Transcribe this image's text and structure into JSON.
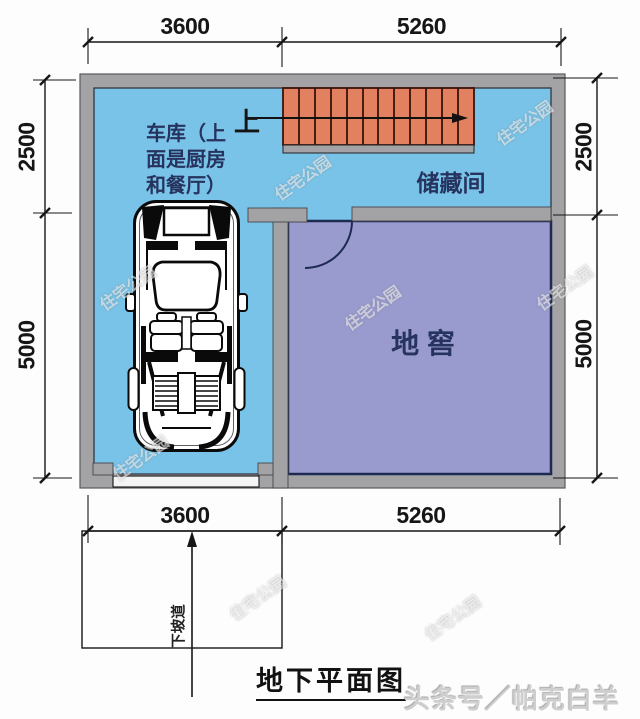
{
  "plan": {
    "title": "地下平面图",
    "byline": "头条号／帕克白羊",
    "watermark": "住宅公园",
    "rooms": {
      "garage": {
        "line1": "车库（上",
        "line2": "面是厨房",
        "line3": "和餐厅）"
      },
      "storage": {
        "label": "储藏间"
      },
      "cellar": {
        "label": "地 窖"
      }
    },
    "stairs": {
      "up": "上"
    },
    "ramp": {
      "label": "下坡道"
    },
    "dims": {
      "top_left": "3600",
      "top_right": "5260",
      "bottom_left": "3600",
      "bottom_right": "5260",
      "left_upper": "2500",
      "left_lower": "5000",
      "right_upper": "2500",
      "right_lower": "5000"
    },
    "colors": {
      "garage_floor": "#79c3e8",
      "cellar_floor": "#999bce",
      "wall": "#a3a3a5",
      "stairs": "#e2815f",
      "room_label": "#26335e"
    }
  }
}
